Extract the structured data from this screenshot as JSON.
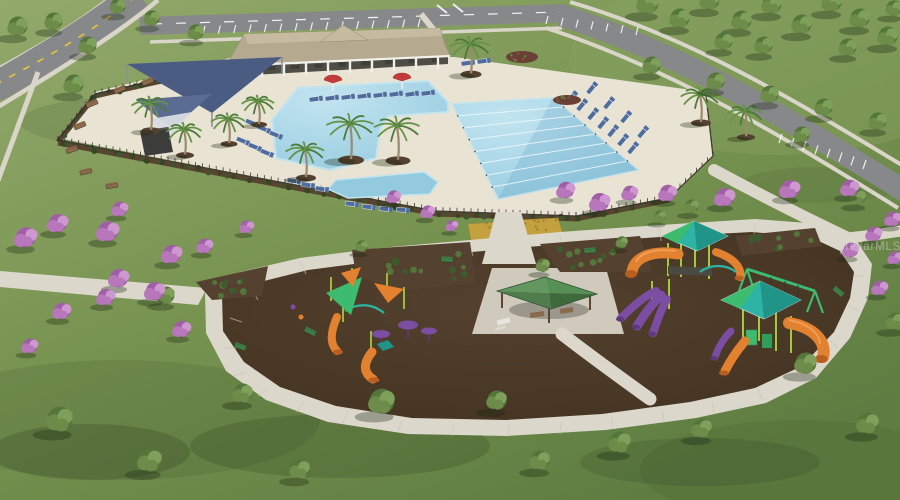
{
  "image": {
    "type": "aerial-3d-architectural-rendering",
    "subject": "community amenity center: clubhouse pavilion, resort pool with lap lanes, shade sails, fenced pool deck, playground loop with play structures and picnic pavilion, roads with parking, flowering trees",
    "width": 900,
    "height": 500
  },
  "watermark": {
    "text": "StellarMLS"
  },
  "palette": {
    "grass1": "#93a96c",
    "grass2": "#76924f",
    "grass3": "#5f7d42",
    "asphalt": "#87888a",
    "sidewalk": "#d9d5c9",
    "pathLight": "#dbd7cb",
    "deck": "#e9e3d3",
    "water": "#93cade",
    "waterLight": "#c2e4f0",
    "waterDeep": "#5f9fc2",
    "laneWhite": "#f0f9fd",
    "roofTan": "#b5aa90",
    "roofTanLight": "#c6bba1",
    "roofTanDark": "#a1967c",
    "fascia": "#f2f0ea",
    "underRoof": "#4e4e46",
    "sailBlue": "#4b5c82",
    "sailBlue2": "#5a6c92",
    "sailWhite": "#d8dce2",
    "fenceDark": "#33302b",
    "hedgeBrown": "#5a4330",
    "hedgeG1": "#44532f",
    "hedgeG2": "#374625",
    "mulch": "#42321f",
    "mulchLight": "#54412f",
    "goldBed": "#c3a13f",
    "bloom1": "#b877bb",
    "bloom2": "#a05ea6",
    "bloom3": "#cf97d1",
    "treeG1": "#6d8c4a",
    "treeG2": "#55763a",
    "treeG3": "#7fa05a",
    "trunk": "#6b5a44",
    "palmG1": "#4d7a39",
    "palmG2": "#659348",
    "pgLime": "#a6c83d",
    "pgOrange": "#e2812f",
    "pgOrangeDark": "#b85e1f",
    "pgPurple": "#7c4ea3",
    "pgPurpleDark": "#5e3a7d",
    "pgTeal": "#2eb4a4",
    "pgTealDark": "#1f9487",
    "pgGreen": "#3dbb6e",
    "pavG1": "#63975f",
    "pavG2": "#569055",
    "pavG3": "#4f7d4b",
    "pavG4": "#3f6a3c",
    "chairBlue": "#4e6d9e",
    "chairWhite": "#e6e6e3",
    "benchBrown": "#8a6a4a",
    "benchGreen": "#3e7d46",
    "white": "#ffffff",
    "yellow": "#e8c53a",
    "shadow": "rgba(22,36,16,0.32)",
    "watermark": "rgba(212,212,212,0.55)"
  },
  "scene": {
    "clubhouse": {
      "columns": [
        [
          240,
          65
        ],
        [
          262,
          64
        ],
        [
          284,
          63
        ],
        [
          306,
          62
        ],
        [
          328,
          61
        ],
        [
          350,
          60
        ],
        [
          372,
          59
        ],
        [
          394,
          58
        ],
        [
          416,
          57
        ],
        [
          438,
          56
        ]
      ],
      "furniture_row": {
        "x1": 248,
        "y1": 71,
        "x2": 436,
        "y2": 62,
        "n": 9
      }
    },
    "pool": {
      "lanes": {
        "a1": [
          452,
          104
        ],
        "a2": [
          553,
          98
        ],
        "b1": [
          498,
          199
        ],
        "b2": [
          638,
          170
        ],
        "count": 7
      }
    },
    "parking_rows": [
      {
        "x1": 205,
        "y1": 26,
        "x2": 420,
        "y2": 19,
        "count": 15,
        "dx": -2,
        "dy": 8
      },
      {
        "x1": 548,
        "y1": 16,
        "x2": 638,
        "y2": 27,
        "count": 7,
        "dx": -2,
        "dy": 8
      },
      {
        "x1": 782,
        "y1": 134,
        "x2": 866,
        "y2": 160,
        "count": 8,
        "dx": -3,
        "dy": 9
      }
    ],
    "fence": {
      "points": [
        [
          228,
          64
        ],
        [
          95,
          94
        ],
        [
          58,
          140
        ],
        [
          285,
          183
        ],
        [
          436,
          211
        ],
        [
          576,
          216
        ],
        [
          669,
          198
        ],
        [
          713,
          156
        ],
        [
          706,
          96
        ]
      ],
      "post_spacing": 7
    },
    "hedges": [
      {
        "x1": 228,
        "y1": 66,
        "x2": 95,
        "y2": 96,
        "n": 16
      },
      {
        "x1": 95,
        "y1": 96,
        "x2": 58,
        "y2": 142,
        "n": 6
      },
      {
        "x1": 58,
        "y1": 143,
        "x2": 285,
        "y2": 186,
        "n": 26
      },
      {
        "x1": 285,
        "y1": 186,
        "x2": 436,
        "y2": 214,
        "n": 17
      },
      {
        "x1": 436,
        "y1": 214,
        "x2": 576,
        "y2": 219,
        "n": 15
      },
      {
        "x1": 576,
        "y1": 219,
        "x2": 669,
        "y2": 200,
        "n": 10
      }
    ],
    "beds": [
      {
        "pts": [
          [
            352,
            250
          ],
          [
            470,
            242
          ],
          [
            476,
            284
          ],
          [
            400,
            290
          ],
          [
            356,
            276
          ]
        ],
        "n": 13
      },
      {
        "pts": [
          [
            540,
            244
          ],
          [
            640,
            236
          ],
          [
            652,
            272
          ],
          [
            560,
            272
          ]
        ],
        "n": 12
      },
      {
        "pts": [
          [
            735,
            236
          ],
          [
            815,
            228
          ],
          [
            822,
            246
          ],
          [
            742,
            256
          ]
        ],
        "n": 9
      },
      {
        "pts": [
          [
            196,
            282
          ],
          [
            268,
            266
          ],
          [
            262,
            296
          ],
          [
            212,
            300
          ]
        ],
        "n": 10
      }
    ],
    "gold_beds": [
      [
        [
          468,
          224
        ],
        [
          512,
          221
        ],
        [
          516,
          242
        ],
        [
          472,
          246
        ]
      ],
      [
        [
          518,
          220
        ],
        [
          558,
          218
        ],
        [
          564,
          238
        ],
        [
          520,
          241
        ]
      ]
    ],
    "mounds": [
      [
        522,
        57,
        16,
        6
      ],
      [
        567,
        100,
        14,
        5
      ]
    ],
    "lawn_shadows": [
      [
        140,
        122,
        120,
        26,
        0.1
      ],
      [
        340,
        446,
        150,
        32,
        0.16
      ],
      [
        90,
        452,
        100,
        28,
        0.18
      ],
      [
        700,
        462,
        120,
        24,
        0.12
      ],
      [
        820,
        185,
        80,
        18,
        0.08
      ],
      [
        560,
        300,
        60,
        16,
        0.15
      ],
      [
        700,
        305,
        55,
        14,
        0.15
      ],
      [
        420,
        310,
        55,
        14,
        0.12
      ],
      [
        120,
        420,
        200,
        60,
        0.1
      ],
      [
        800,
        470,
        160,
        50,
        0.08
      ]
    ],
    "trees_green": [
      [
        18,
        36,
        10
      ],
      [
        54,
        30,
        9
      ],
      [
        88,
        54,
        9
      ],
      [
        118,
        14,
        8
      ],
      [
        74,
        94,
        10
      ],
      [
        152,
        26,
        8
      ],
      [
        196,
        40,
        8
      ],
      [
        648,
        14,
        11
      ],
      [
        680,
        28,
        10
      ],
      [
        710,
        10,
        10
      ],
      [
        742,
        30,
        10
      ],
      [
        772,
        14,
        10
      ],
      [
        802,
        34,
        10
      ],
      [
        832,
        12,
        10
      ],
      [
        860,
        28,
        10
      ],
      [
        888,
        46,
        10
      ],
      [
        724,
        50,
        9
      ],
      [
        764,
        54,
        9
      ],
      [
        848,
        56,
        9
      ],
      [
        894,
        16,
        8
      ],
      [
        652,
        74,
        9
      ],
      [
        716,
        90,
        9
      ],
      [
        770,
        103,
        9
      ],
      [
        824,
        116,
        9
      ],
      [
        878,
        130,
        9
      ],
      [
        802,
        142,
        8
      ],
      [
        858,
        205,
        8
      ],
      [
        692,
        213,
        7
      ],
      [
        660,
        222,
        6
      ],
      [
        362,
        252,
        6
      ],
      [
        622,
        248,
        6
      ],
      [
        543,
        272,
        7
      ],
      [
        166,
        304,
        9
      ],
      [
        243,
        403,
        10
      ],
      [
        60,
        432,
        13
      ],
      [
        150,
        472,
        12
      ],
      [
        382,
        414,
        13
      ],
      [
        497,
        410,
        10
      ],
      [
        620,
        453,
        11
      ],
      [
        702,
        438,
        10
      ],
      [
        806,
        374,
        11
      ],
      [
        868,
        434,
        11
      ],
      [
        300,
        479,
        10
      ],
      [
        540,
        470,
        10
      ],
      [
        895,
        330,
        9
      ]
    ],
    "trees_purple": [
      [
        26,
        247,
        11
      ],
      [
        58,
        232,
        10
      ],
      [
        108,
        241,
        11
      ],
      [
        119,
        287,
        10
      ],
      [
        172,
        263,
        10
      ],
      [
        106,
        305,
        9
      ],
      [
        62,
        319,
        9
      ],
      [
        30,
        353,
        8
      ],
      [
        205,
        253,
        8
      ],
      [
        247,
        233,
        7
      ],
      [
        155,
        300,
        10
      ],
      [
        182,
        337,
        9
      ],
      [
        120,
        216,
        8
      ],
      [
        394,
        203,
        7
      ],
      [
        428,
        218,
        7
      ],
      [
        452,
        231,
        6
      ],
      [
        566,
        198,
        9
      ],
      [
        600,
        211,
        10
      ],
      [
        630,
        200,
        8
      ],
      [
        668,
        201,
        9
      ],
      [
        725,
        206,
        10
      ],
      [
        790,
        198,
        10
      ],
      [
        850,
        196,
        9
      ],
      [
        893,
        226,
        8
      ],
      [
        874,
        241,
        8
      ],
      [
        851,
        257,
        8
      ],
      [
        895,
        264,
        7
      ],
      [
        880,
        295,
        8
      ]
    ],
    "palms": [
      [
        350,
        124,
        1.3
      ],
      [
        397,
        126,
        1.25
      ],
      [
        305,
        150,
        1.0
      ],
      [
        470,
        45,
        1.05
      ],
      [
        700,
        95,
        1.0
      ],
      [
        745,
        112,
        0.9
      ],
      [
        150,
        104,
        0.95
      ],
      [
        184,
        130,
        0.9
      ],
      [
        228,
        120,
        0.85
      ],
      [
        258,
        102,
        0.8
      ]
    ],
    "lounge_chairs": [
      [
        316,
        99,
        -8
      ],
      [
        332,
        98,
        -8
      ],
      [
        348,
        97,
        -8
      ],
      [
        364,
        96,
        -8
      ],
      [
        380,
        95,
        -8
      ],
      [
        396,
        94,
        -8
      ],
      [
        412,
        94,
        -8
      ],
      [
        428,
        93,
        -8
      ],
      [
        468,
        63,
        -8
      ],
      [
        484,
        61,
        -8
      ],
      [
        252,
        123,
        22
      ],
      [
        264,
        129,
        22
      ],
      [
        276,
        135,
        22
      ],
      [
        243,
        141,
        22
      ],
      [
        255,
        147,
        22
      ],
      [
        267,
        153,
        22
      ],
      [
        294,
        181,
        8
      ],
      [
        308,
        185,
        8
      ],
      [
        322,
        189,
        8
      ],
      [
        352,
        204,
        6
      ],
      [
        369,
        207,
        6
      ],
      [
        386,
        209,
        6
      ],
      [
        403,
        210,
        6
      ],
      [
        572,
        97,
        -50
      ],
      [
        582,
        105,
        -50
      ],
      [
        593,
        114,
        -50
      ],
      [
        603,
        123,
        -50
      ],
      [
        613,
        131,
        -50
      ],
      [
        623,
        140,
        -50
      ],
      [
        633,
        148,
        -50
      ],
      [
        592,
        88,
        -50
      ],
      [
        609,
        103,
        -50
      ],
      [
        626,
        117,
        -50
      ],
      [
        643,
        132,
        -50
      ]
    ],
    "benches": [
      [
        92,
        104,
        -22,
        "brown"
      ],
      [
        80,
        126,
        -22,
        "brown"
      ],
      [
        72,
        150,
        -20,
        "brown"
      ],
      [
        86,
        172,
        -14,
        "brown"
      ],
      [
        112,
        186,
        -8,
        "brown"
      ],
      [
        148,
        82,
        -22,
        "brown"
      ],
      [
        120,
        90,
        -22,
        "brown"
      ],
      [
        447,
        260,
        4,
        "green"
      ],
      [
        590,
        251,
        -4,
        "green"
      ],
      [
        838,
        292,
        40,
        "green"
      ],
      [
        310,
        332,
        28,
        "green"
      ],
      [
        240,
        347,
        20,
        "green"
      ]
    ],
    "path_joints": [
      [
        251,
        288,
        258,
        300
      ],
      [
        230,
        318,
        242,
        322
      ],
      [
        224,
        348,
        237,
        348
      ],
      [
        234,
        376,
        246,
        372
      ],
      [
        258,
        396,
        268,
        388
      ],
      [
        296,
        412,
        304,
        402
      ],
      [
        342,
        424,
        348,
        412
      ],
      [
        398,
        432,
        402,
        420
      ],
      [
        452,
        436,
        454,
        424
      ],
      [
        508,
        437,
        509,
        425
      ],
      [
        560,
        434,
        561,
        422
      ],
      [
        612,
        429,
        612,
        417
      ],
      [
        664,
        423,
        663,
        411
      ],
      [
        714,
        414,
        712,
        402
      ],
      [
        762,
        400,
        758,
        389
      ],
      [
        804,
        378,
        798,
        368
      ],
      [
        838,
        348,
        830,
        341
      ],
      [
        858,
        310,
        849,
        306
      ],
      [
        864,
        276,
        854,
        276
      ],
      [
        846,
        246,
        840,
        254
      ],
      [
        470,
        244,
        473,
        256
      ],
      [
        380,
        252,
        384,
        264
      ],
      [
        300,
        262,
        306,
        274
      ],
      [
        560,
        236,
        562,
        248
      ],
      [
        660,
        229,
        661,
        241
      ],
      [
        755,
        223,
        754,
        235
      ]
    ]
  }
}
